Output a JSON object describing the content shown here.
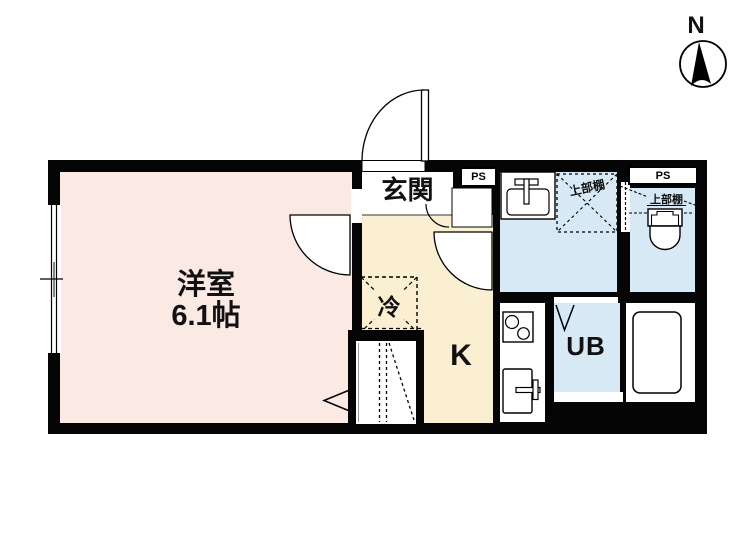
{
  "compass": {
    "label": "N"
  },
  "rooms": {
    "living": {
      "name": "洋室",
      "size": "6.1帖"
    },
    "entrance": {
      "label": "玄関"
    },
    "kitchen": {
      "label": "K"
    },
    "fridge": {
      "label": "冷"
    },
    "unit_bath": {
      "label": "UB"
    },
    "pipe_space_1": {
      "label": "PS"
    },
    "pipe_space_2": {
      "label": "PS"
    },
    "shelf_washroom": {
      "label": "上部棚"
    },
    "shelf_toilet": {
      "label": "上部棚"
    }
  },
  "colors": {
    "wall": "#050505",
    "living_room_floor": "#FBE9E3",
    "kitchen_floor": "#FAEFD0",
    "wet_area_floor": "#D6E9F5",
    "hall_floor": "#FFFFFF"
  }
}
